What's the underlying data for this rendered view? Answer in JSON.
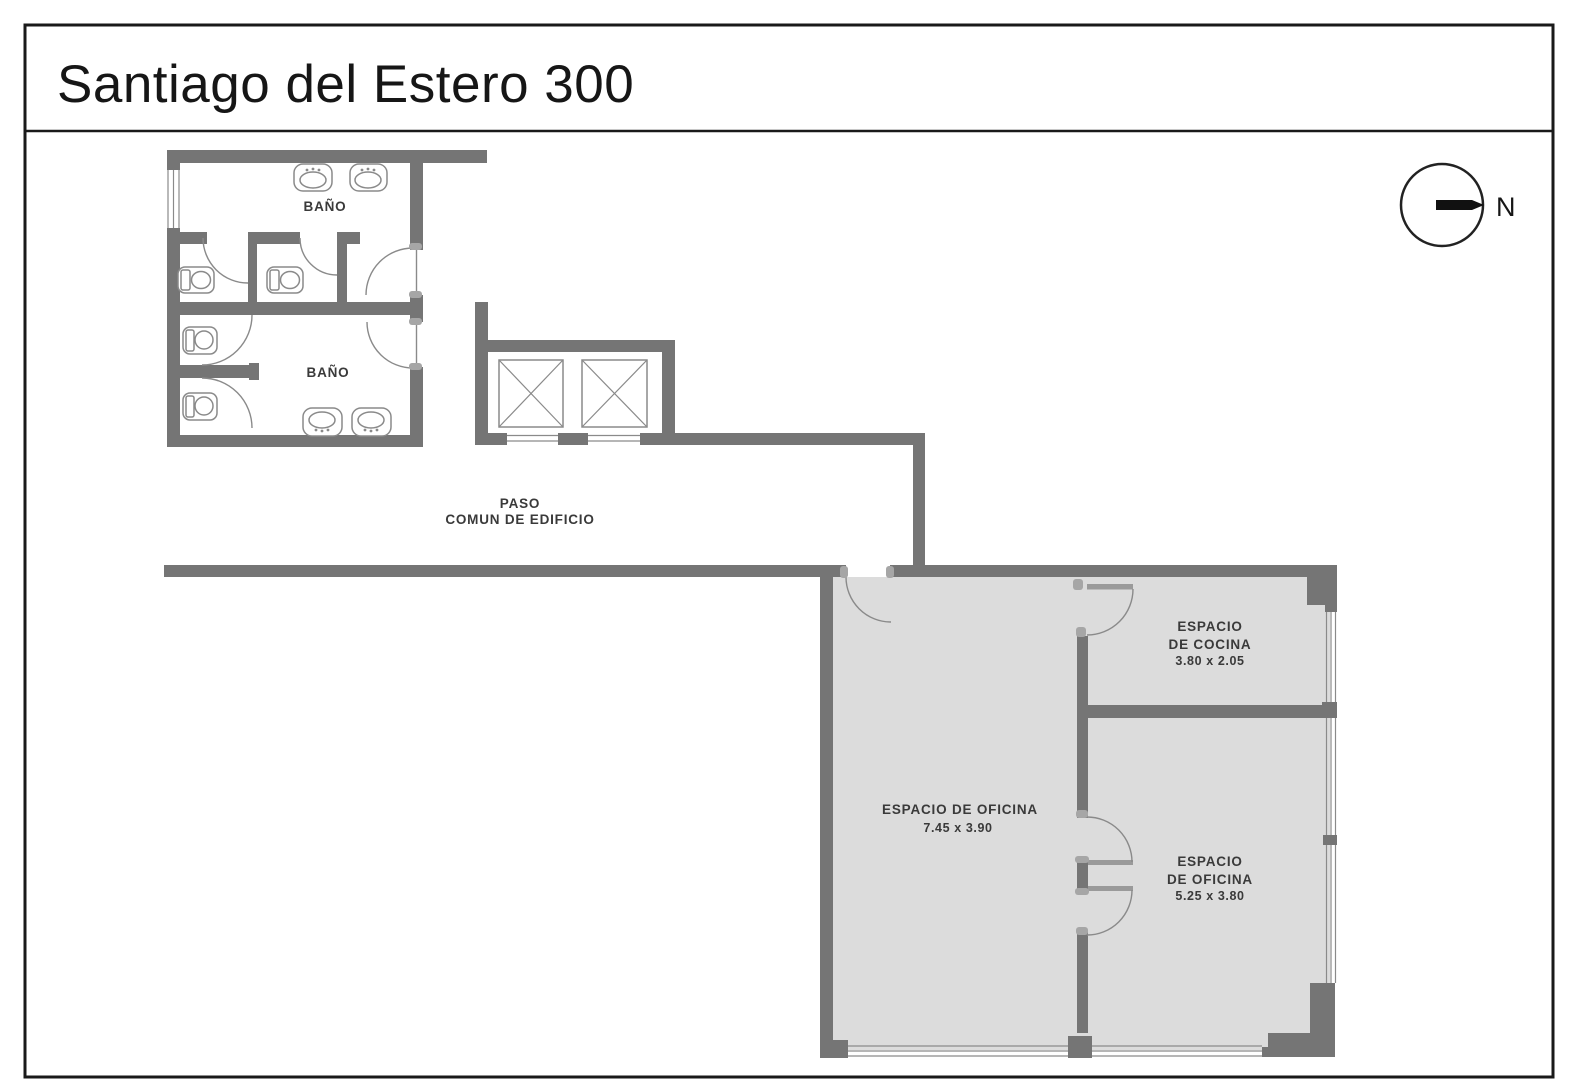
{
  "title": "Santiago del Estero 300",
  "compass": {
    "label": "N"
  },
  "colors": {
    "wall": "#757575",
    "room_fill": "#dcdcdc",
    "fixture_line": "#8a8a8a",
    "frame": "#1a1a1a",
    "label_text": "#3a3a3a"
  },
  "labels": {
    "bathroom_top": "BAÑO",
    "bathroom_bottom": "BAÑO",
    "corridor_line1": "PASO",
    "corridor_line2": "COMUN DE EDIFICIO",
    "kitchen": {
      "line1": "ESPACIO",
      "line2": "DE COCINA",
      "dims": "3.80 x 2.05"
    },
    "office_main": {
      "line1": "ESPACIO DE OFICINA",
      "dims": "7.45 x 3.90"
    },
    "office_small": {
      "line1": "ESPACIO",
      "line2": "DE OFICINA",
      "dims": "5.25 x 3.80"
    }
  }
}
